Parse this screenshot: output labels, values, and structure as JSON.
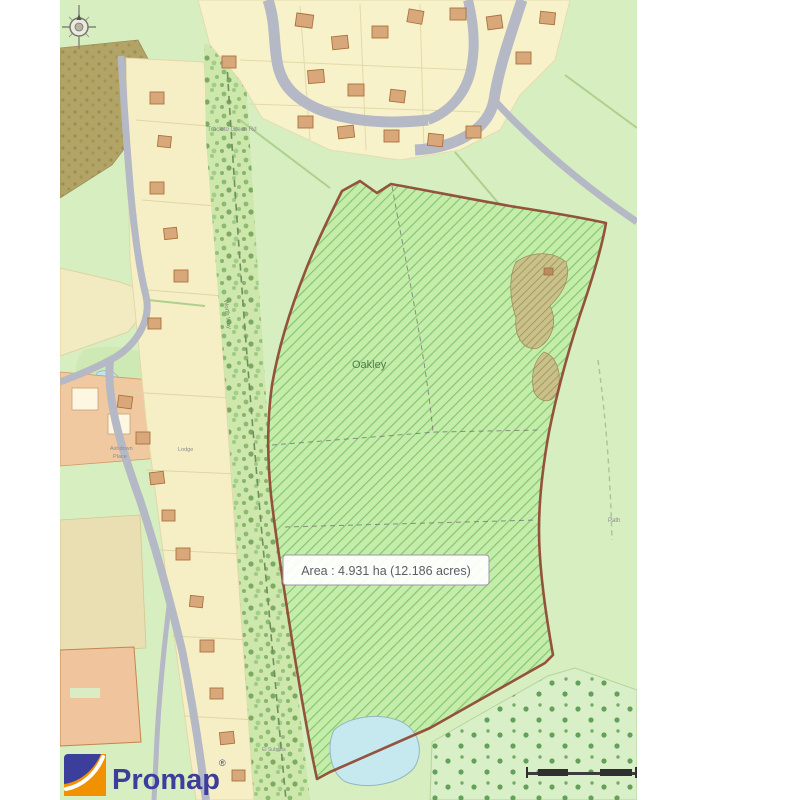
{
  "branding": {
    "logo_text": "Promap",
    "trademark": "®"
  },
  "map": {
    "parcel": {
      "name_label": "Oakley",
      "area_label": "Area : 4.931 ha (12.186 acres)"
    },
    "labels": {
      "track": "Track to Green Rd",
      "substation": "El Sub Sta",
      "path": "Path",
      "railway": "Worth Way",
      "estate_1": "Ashdown",
      "estate_2": "Place",
      "estate_3": "Lodge"
    },
    "colors": {
      "parcel_outline": "#8e4531",
      "parcel_fill": "#c6ecac",
      "parcel_hatch": "#7fcb6c",
      "base_green": "#d6eec0",
      "estate_cream": "#f8f2cb",
      "road_gray": "#b5b8c5",
      "house_orange": "#d9a87a",
      "pond_blue": "#c5e9ef",
      "woodland_olive": "#b2a467",
      "logo_blue": "#3c3e9b",
      "logo_orange": "#f29100"
    }
  }
}
